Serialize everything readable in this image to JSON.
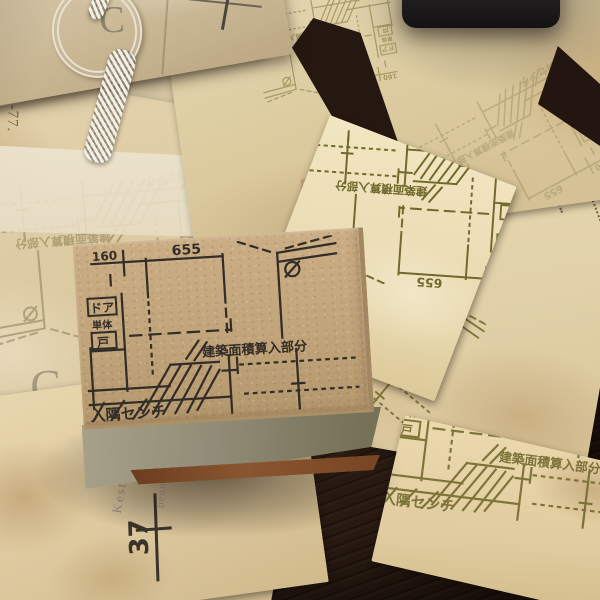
{
  "scene": {
    "subject": "Rubber stamp of a Japanese architectural detail drawing on a kraft wood block, surrounded by stamped vintage papers on a dark wood table"
  },
  "stamp_design": {
    "dim_left": "160",
    "dim_main": "655",
    "label_door": "ドア",
    "label_single": "単体",
    "label_to": "戸",
    "label_area": "建築面積算入部分",
    "label_corner": "入隅センチ"
  },
  "paper_texts": {
    "budapest": "Budapest, 19",
    "number_37": "37",
    "code_377": "3-77.",
    "letter_c_package": "C",
    "letter_c_paper": "C",
    "faint_word_1": "Kest",
    "faint_word_2": "benn"
  },
  "colors": {
    "table_wood": "#2e1d13",
    "paper_cream": "#e3d1a9",
    "stamp_block_top": "#c4a87f",
    "stamp_block_side": "#8f8b76",
    "stamp_base_wood": "#7c4a27",
    "ink_black": "#322d26",
    "ink_olive": "#6f6526",
    "black_object": "#1c191a",
    "cord_silver": "#e9e3d6"
  }
}
